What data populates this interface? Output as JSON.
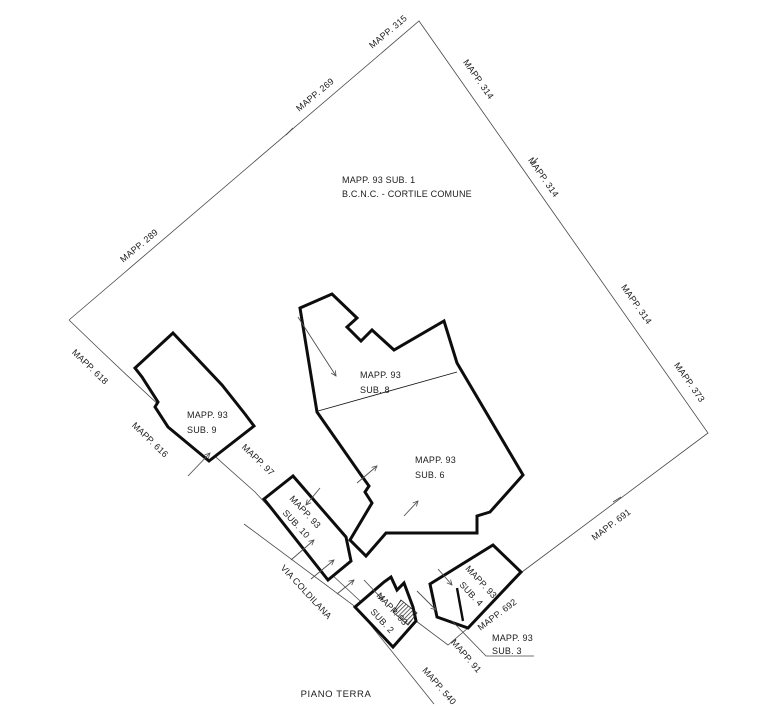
{
  "colors": {
    "ink": "#1c1c1c",
    "wall": "#0d0d0d",
    "thin": "#4a4a4a",
    "arrow": "#4f4f4f",
    "paper": "#ffffff"
  },
  "title": {
    "text": "PIANO TERRA"
  },
  "courtyard": {
    "line1": "MAPP. 93 SUB. 1",
    "line2": "B.C.N.C. - CORTILE COMUNE"
  },
  "street": {
    "name": "VIA COLDILANA"
  },
  "boundary_labels": {
    "mapp315": "MAPP. 315",
    "mapp269": "MAPP. 269",
    "mapp289": "MAPP. 289",
    "mapp314a": "MAPP. 314",
    "mapp314b": "MAPP. 314",
    "mapp314c": "MAPP. 314",
    "mapp373": "MAPP. 373",
    "mapp618": "MAPP. 618",
    "mapp616": "MAPP. 616",
    "mapp97": "MAPP. 97",
    "mapp691": "MAPP. 691",
    "mapp692": "MAPP. 692",
    "mapp91": "MAPP. 91",
    "mapp540": "MAPP. 540"
  },
  "buildings": {
    "sub9": {
      "line1": "MAPP. 93",
      "line2": "SUB. 9"
    },
    "sub8": {
      "line1": "MAPP. 93",
      "line2": "SUB. 8"
    },
    "sub6": {
      "line1": "MAPP. 93",
      "line2": "SUB. 6"
    },
    "sub10": {
      "line1": "MAPP. 93",
      "line2": "SUB. 10"
    },
    "sub2": {
      "line1": "MAPP. 93",
      "line2": "SUB. 2"
    },
    "sub4": {
      "line1": "MAPP. 93",
      "line2": "SUB. 4"
    },
    "sub3": {
      "line1": "MAPP. 93",
      "line2": "SUB. 3"
    }
  }
}
